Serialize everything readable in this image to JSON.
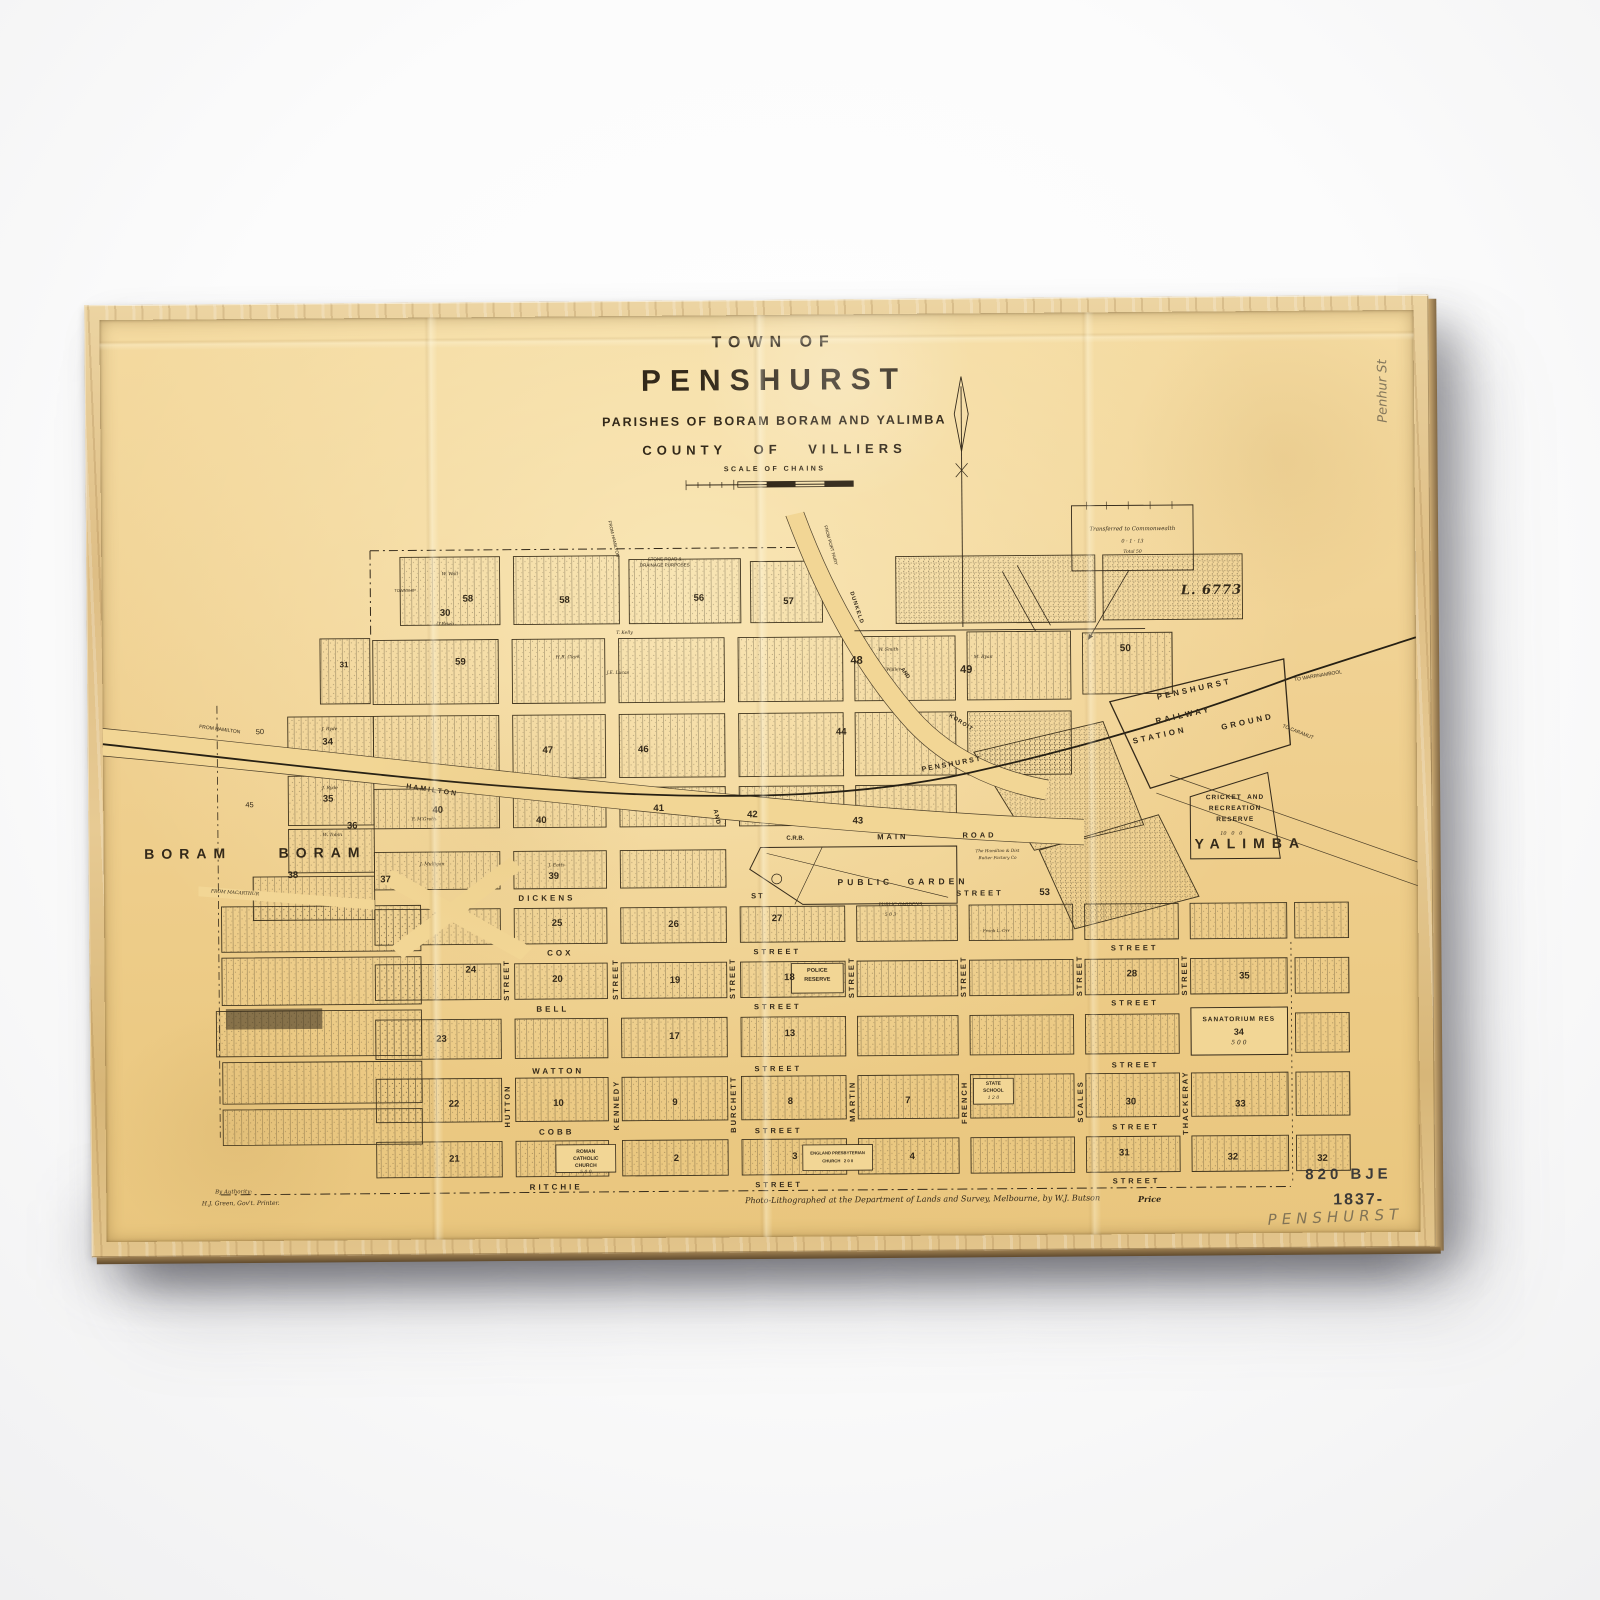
{
  "colors": {
    "paper": "#f0d192",
    "ink": "#33291a",
    "frame_wood": "#ddbd84",
    "pencil": "#645c4c",
    "wall": "#fafafa"
  },
  "map": {
    "title": {
      "line1": "TOWN OF",
      "line2": "PENSHURST",
      "line3": "PARISHES OF BORAM BORAM AND YALIMBA",
      "line4": "COUNTY OF VILLIERS",
      "scale_label": "SCALE OF CHAINS"
    },
    "labels": [
      {
        "t": "DICKENS",
        "x": 445,
        "y": 590,
        "s": 8,
        "ls": 3
      },
      {
        "t": "ST",
        "x": 657,
        "y": 589,
        "s": 7.5,
        "ls": 2
      },
      {
        "t": "STREET",
        "x": 880,
        "y": 588,
        "s": 7.5,
        "ls": 3
      },
      {
        "t": "COX",
        "x": 458,
        "y": 646,
        "s": 8,
        "ls": 3
      },
      {
        "t": "STREET",
        "x": 676,
        "y": 646,
        "s": 7.5,
        "ls": 3
      },
      {
        "t": "STREET",
        "x": 1035,
        "y": 645,
        "s": 7.5,
        "ls": 3
      },
      {
        "t": "BELL",
        "x": 450,
        "y": 703,
        "s": 8,
        "ls": 3
      },
      {
        "t": "STREET",
        "x": 676,
        "y": 702,
        "s": 7.5,
        "ls": 3
      },
      {
        "t": "STREET",
        "x": 1035,
        "y": 701,
        "s": 7.5,
        "ls": 3
      },
      {
        "t": "WATTON",
        "x": 455,
        "y": 766,
        "s": 8,
        "ls": 3
      },
      {
        "t": "STREET",
        "x": 676,
        "y": 765,
        "s": 7.5,
        "ls": 3
      },
      {
        "t": "STREET",
        "x": 1035,
        "y": 764,
        "s": 7.5,
        "ls": 3
      },
      {
        "t": "COBB",
        "x": 453,
        "y": 828,
        "s": 8,
        "ls": 3
      },
      {
        "t": "STREET",
        "x": 676,
        "y": 827,
        "s": 7.5,
        "ls": 3
      },
      {
        "t": "STREET",
        "x": 1035,
        "y": 826,
        "s": 7.5,
        "ls": 3
      },
      {
        "t": "RITCHIE",
        "x": 452,
        "y": 883,
        "s": 8,
        "ls": 3
      },
      {
        "t": "STREET",
        "x": 676,
        "y": 882,
        "s": 7.5,
        "ls": 3
      },
      {
        "t": "STREET",
        "x": 1035,
        "y": 881,
        "s": 7.5,
        "ls": 3
      },
      {
        "t": "C.R.B.",
        "x": 695,
        "y": 531,
        "s": 6
      },
      {
        "t": "MAIN",
        "x": 793,
        "y": 530,
        "s": 7.5,
        "ls": 3
      },
      {
        "t": "ROAD",
        "x": 880,
        "y": 529,
        "s": 7.5,
        "ls": 3
      },
      {
        "t": "STREET",
        "x": 404,
        "y": 672,
        "s": 7.5,
        "ls": 2,
        "r": -90
      },
      {
        "t": "HUTTON",
        "x": 404,
        "y": 800,
        "s": 7.5,
        "ls": 2,
        "r": -90
      },
      {
        "t": "STREET",
        "x": 513,
        "y": 672,
        "s": 7.5,
        "ls": 2,
        "r": -90
      },
      {
        "t": "KENNEDY",
        "x": 513,
        "y": 800,
        "s": 7.5,
        "ls": 2,
        "r": -90
      },
      {
        "t": "STREET",
        "x": 631,
        "y": 672,
        "s": 7.5,
        "ls": 2,
        "r": -90
      },
      {
        "t": "BURCHETT",
        "x": 631,
        "y": 800,
        "s": 7.5,
        "ls": 2,
        "r": -90
      },
      {
        "t": "STREET",
        "x": 750,
        "y": 672,
        "s": 7.5,
        "ls": 2,
        "r": -90
      },
      {
        "t": "MARTIN",
        "x": 750,
        "y": 798,
        "s": 7.5,
        "ls": 2,
        "r": -90
      },
      {
        "t": "STREET",
        "x": 863,
        "y": 672,
        "s": 7.5,
        "ls": 2,
        "r": -90
      },
      {
        "t": "FRENCH",
        "x": 863,
        "y": 800,
        "s": 7.5,
        "ls": 2,
        "r": -90
      },
      {
        "t": "STREET",
        "x": 979,
        "y": 672,
        "s": 7.5,
        "ls": 2,
        "r": -90
      },
      {
        "t": "SCALES",
        "x": 979,
        "y": 800,
        "s": 7.5,
        "ls": 2,
        "r": -90
      },
      {
        "t": "STREET",
        "x": 1085,
        "y": 672,
        "s": 7.5,
        "ls": 2,
        "r": -90
      },
      {
        "t": "THACKERAY",
        "x": 1085,
        "y": 802,
        "s": 7.5,
        "ls": 2,
        "r": -90
      },
      {
        "t": "FROM HAMILTON",
        "x": 118,
        "y": 417,
        "s": 5,
        "r": 8,
        "c": "n"
      },
      {
        "t": "HAMILTON",
        "x": 330,
        "y": 480,
        "s": 7,
        "r": 9,
        "ls": 2
      },
      {
        "t": "AND",
        "x": 616,
        "y": 509,
        "s": 6,
        "r": 78,
        "ls": 1
      },
      {
        "t": "PENSHURST",
        "x": 853,
        "y": 457,
        "s": 7,
        "r": -10,
        "ls": 2
      },
      {
        "t": "FROM HAMILTON",
        "x": 514,
        "y": 226,
        "s": 4.5,
        "r": 77,
        "c": "n"
      },
      {
        "t": "STONE ROAD &",
        "x": 566,
        "y": 247,
        "s": 4.5,
        "c": "n"
      },
      {
        "t": "DRAINAGE PURPOSES",
        "x": 566,
        "y": 254,
        "s": 4.5,
        "c": "n"
      },
      {
        "t": "FROM PORT FAIRY",
        "x": 732,
        "y": 234,
        "s": 4.5,
        "r": 75,
        "c": "n"
      },
      {
        "t": "DUNKELD",
        "x": 757,
        "y": 298,
        "s": 5.5,
        "r": 72,
        "ls": 1
      },
      {
        "t": "AND",
        "x": 806,
        "y": 365,
        "s": 5.5,
        "r": 55
      },
      {
        "t": "KOROIT",
        "x": 862,
        "y": 416,
        "s": 5.5,
        "r": 33,
        "ls": 1
      },
      {
        "t": "TO WARRNAMBOOL",
        "x": 1222,
        "y": 371,
        "s": 5,
        "r": -9,
        "c": "n"
      },
      {
        "t": "TO CARAMUT",
        "x": 1200,
        "y": 428,
        "s": 5,
        "r": 22,
        "c": "n"
      },
      {
        "t": "FROM MACARTHUR",
        "x": 132,
        "y": 583,
        "s": 4.5,
        "r": 4,
        "c": "i"
      },
      {
        "t": "PENSHURST",
        "x": 1097,
        "y": 383,
        "s": 8,
        "r": -12,
        "ls": 3
      },
      {
        "t": "RAILWAY",
        "x": 1086,
        "y": 410,
        "s": 8,
        "r": -12,
        "ls": 3
      },
      {
        "t": "STATION",
        "x": 1062,
        "y": 430,
        "s": 8,
        "r": -12,
        "ls": 3
      },
      {
        "t": "GROUND",
        "x": 1150,
        "y": 417,
        "s": 8,
        "r": -12,
        "ls": 3
      },
      {
        "t": "CRICKET  AND",
        "x": 1137,
        "y": 494,
        "s": 6.5,
        "ls": 1
      },
      {
        "t": "RECREATION",
        "x": 1137,
        "y": 505,
        "s": 6.5,
        "ls": 1
      },
      {
        "t": "RESERVE",
        "x": 1137,
        "y": 516,
        "s": 6.5,
        "ls": 1
      },
      {
        "t": "10   0   0",
        "x": 1133,
        "y": 530,
        "s": 5,
        "c": "i"
      },
      {
        "t": "YALIMBA",
        "x": 1152,
        "y": 540,
        "s": 14,
        "ls": 7
      },
      {
        "t": "BORAM",
        "x": 85,
        "y": 542,
        "s": 14,
        "ls": 7
      },
      {
        "t": "BORAM",
        "x": 220,
        "y": 542,
        "s": 14,
        "ls": 7
      },
      {
        "t": "PUBLIC",
        "x": 765,
        "y": 576,
        "s": 8.5,
        "ls": 4
      },
      {
        "t": "GARDEN",
        "x": 838,
        "y": 576,
        "s": 8.5,
        "ls": 4
      },
      {
        "t": "PUBLIC GARDENS",
        "x": 800,
        "y": 600,
        "s": 4.5,
        "c": "i"
      },
      {
        "t": "5 0 3",
        "x": 790,
        "y": 610,
        "s": 4.5,
        "c": "i"
      },
      {
        "t": "POLICE",
        "x": 716,
        "y": 666,
        "s": 5.5
      },
      {
        "t": "RESERVE",
        "x": 716,
        "y": 675,
        "s": 5.5
      },
      {
        "t": "STATE",
        "x": 892,
        "y": 783,
        "s": 4.8
      },
      {
        "t": "SCHOOL",
        "x": 892,
        "y": 790,
        "s": 4.8
      },
      {
        "t": "1 2 0",
        "x": 892,
        "y": 797,
        "s": 4.5,
        "c": "i"
      },
      {
        "t": "ROMAN",
        "x": 482,
        "y": 848,
        "s": 5
      },
      {
        "t": "CATHOLIC",
        "x": 482,
        "y": 855,
        "s": 5
      },
      {
        "t": "CHURCH",
        "x": 482,
        "y": 862,
        "s": 5
      },
      {
        "t": "5 0 0",
        "x": 482,
        "y": 869,
        "s": 4.5,
        "c": "i"
      },
      {
        "t": "ENGLAND PRESBYTERIAN",
        "x": 735,
        "y": 851,
        "s": 4.2
      },
      {
        "t": "CHURCH   2 0 0",
        "x": 735,
        "y": 859,
        "s": 4.2
      },
      {
        "t": "SANATORIUM RES",
        "x": 1139,
        "y": 719,
        "s": 6.5,
        "ls": 1
      },
      {
        "t": "34",
        "x": 1139,
        "y": 731,
        "s": 9
      },
      {
        "t": "5 0 0",
        "x": 1139,
        "y": 742,
        "s": 6,
        "c": "i"
      },
      {
        "t": "Transferred to Commonwealth",
        "x": 1036,
        "y": 221,
        "s": 5.5,
        "c": "i"
      },
      {
        "t": "0 · 1 · 13",
        "x": 1036,
        "y": 233,
        "s": 5,
        "c": "i"
      },
      {
        "t": "Total 50",
        "x": 1036,
        "y": 244,
        "s": 4.5,
        "c": "i"
      },
      {
        "t": "L. 6773",
        "x": 1115,
        "y": 283,
        "s": 13,
        "ls": 1,
        "c": "ib"
      },
      {
        "t": "TOWNSHIP",
        "x": 305,
        "y": 277,
        "s": 4,
        "c": "n"
      },
      {
        "t": "58",
        "x": 368,
        "y": 286,
        "s": 9.5
      },
      {
        "t": "58",
        "x": 465,
        "y": 288,
        "s": 9.5
      },
      {
        "t": "56",
        "x": 600,
        "y": 287,
        "s": 9.5
      },
      {
        "t": "57",
        "x": 690,
        "y": 291,
        "s": 9.5
      },
      {
        "t": "30",
        "x": 345,
        "y": 300,
        "s": 9.5
      },
      {
        "t": "31",
        "x": 243,
        "y": 352,
        "s": 8
      },
      {
        "t": "59",
        "x": 360,
        "y": 350,
        "s": 9.5
      },
      {
        "t": "48",
        "x": 758,
        "y": 352,
        "s": 11
      },
      {
        "t": "49",
        "x": 868,
        "y": 362,
        "s": 11
      },
      {
        "t": "50",
        "x": 1028,
        "y": 342,
        "s": 10
      },
      {
        "t": "34",
        "x": 226,
        "y": 430,
        "s": 9.5
      },
      {
        "t": "35",
        "x": 226,
        "y": 488,
        "s": 9.5
      },
      {
        "t": "36",
        "x": 250,
        "y": 515,
        "s": 9.5
      },
      {
        "t": "37",
        "x": 283,
        "y": 570,
        "s": 9.5
      },
      {
        "t": "38",
        "x": 190,
        "y": 565,
        "s": 9.5
      },
      {
        "t": "45",
        "x": 147,
        "y": 493,
        "s": 7.5,
        "c": "n"
      },
      {
        "t": "50",
        "x": 158,
        "y": 419,
        "s": 7.5,
        "c": "n"
      },
      {
        "t": "40",
        "x": 336,
        "y": 500,
        "s": 9.5
      },
      {
        "t": "47",
        "x": 447,
        "y": 440,
        "s": 9.5
      },
      {
        "t": "46",
        "x": 543,
        "y": 440,
        "s": 9.5
      },
      {
        "t": "40",
        "x": 440,
        "y": 511,
        "s": 9.5
      },
      {
        "t": "41",
        "x": 558,
        "y": 500,
        "s": 9.5
      },
      {
        "t": "42",
        "x": 652,
        "y": 507,
        "s": 9.5
      },
      {
        "t": "43",
        "x": 758,
        "y": 514,
        "s": 9.5
      },
      {
        "t": "44",
        "x": 742,
        "y": 424,
        "s": 9.5
      },
      {
        "t": "39",
        "x": 452,
        "y": 568,
        "s": 9.5
      },
      {
        "t": "53",
        "x": 945,
        "y": 588,
        "s": 9.5
      },
      {
        "t": "25",
        "x": 455,
        "y": 616,
        "s": 9.5
      },
      {
        "t": "26",
        "x": 572,
        "y": 618,
        "s": 9.5
      },
      {
        "t": "27",
        "x": 676,
        "y": 613,
        "s": 9.5
      },
      {
        "t": "24",
        "x": 368,
        "y": 662,
        "s": 9.5
      },
      {
        "t": "20",
        "x": 455,
        "y": 672,
        "s": 9.5
      },
      {
        "t": "19",
        "x": 573,
        "y": 674,
        "s": 9.5
      },
      {
        "t": "18",
        "x": 688,
        "y": 672,
        "s": 9.5
      },
      {
        "t": "23",
        "x": 338,
        "y": 732,
        "s": 9.5
      },
      {
        "t": "17",
        "x": 572,
        "y": 731,
        "s": 9.5
      },
      {
        "t": "13",
        "x": 688,
        "y": 729,
        "s": 9.5
      },
      {
        "t": "22",
        "x": 350,
        "y": 798,
        "s": 9.5
      },
      {
        "t": "10",
        "x": 455,
        "y": 798,
        "s": 9.5
      },
      {
        "t": "9",
        "x": 572,
        "y": 798,
        "s": 9.5
      },
      {
        "t": "8",
        "x": 688,
        "y": 798,
        "s": 9.5
      },
      {
        "t": "7",
        "x": 806,
        "y": 798,
        "s": 9.5
      },
      {
        "t": "21",
        "x": 350,
        "y": 854,
        "s": 9.5
      },
      {
        "t": "2",
        "x": 573,
        "y": 855,
        "s": 9.5
      },
      {
        "t": "3",
        "x": 692,
        "y": 854,
        "s": 9.5
      },
      {
        "t": "4",
        "x": 810,
        "y": 855,
        "s": 9.5
      },
      {
        "t": "28",
        "x": 1032,
        "y": 671,
        "s": 9.5
      },
      {
        "t": "35",
        "x": 1145,
        "y": 674,
        "s": 9.5
      },
      {
        "t": "30",
        "x": 1030,
        "y": 801,
        "s": 9.5
      },
      {
        "t": "33",
        "x": 1140,
        "y": 804,
        "s": 9.5
      },
      {
        "t": "31",
        "x": 1023,
        "y": 853,
        "s": 9.5
      },
      {
        "t": "32",
        "x": 1132,
        "y": 858,
        "s": 9.5
      },
      {
        "t": "32",
        "x": 1222,
        "y": 860,
        "s": 9.5
      },
      {
        "t": "W. Wall",
        "x": 350,
        "y": 262,
        "s": 4.5,
        "c": "i"
      },
      {
        "t": "O'Brien",
        "x": 345,
        "y": 312,
        "s": 4.5,
        "c": "i"
      },
      {
        "t": "T. Kelly",
        "x": 525,
        "y": 322,
        "s": 4.5,
        "c": "i"
      },
      {
        "t": "J. Ryde",
        "x": 228,
        "y": 418,
        "s": 4.5,
        "c": "i"
      },
      {
        "t": "J. Ryde",
        "x": 228,
        "y": 478,
        "s": 4.5,
        "c": "i"
      },
      {
        "t": "W. Tobin",
        "x": 230,
        "y": 525,
        "s": 4.5,
        "c": "i"
      },
      {
        "t": "W. Smith",
        "x": 790,
        "y": 342,
        "s": 4.5,
        "c": "i"
      },
      {
        "t": "Waller",
        "x": 795,
        "y": 362,
        "s": 4.5,
        "c": "i"
      },
      {
        "t": "M. Ryan",
        "x": 885,
        "y": 350,
        "s": 4.5,
        "c": "i"
      },
      {
        "t": "H.R. Clark",
        "x": 468,
        "y": 347,
        "s": 4.5,
        "c": "i"
      },
      {
        "t": "J.E. Lucas",
        "x": 518,
        "y": 363,
        "s": 4.5,
        "c": "i"
      },
      {
        "t": "F. M'Groth",
        "x": 322,
        "y": 510,
        "s": 4.5,
        "c": "i"
      },
      {
        "t": "J. Eatts",
        "x": 455,
        "y": 558,
        "s": 4.5,
        "c": "i"
      },
      {
        "t": "J. Mulligan",
        "x": 330,
        "y": 556,
        "s": 4.5,
        "c": "i"
      },
      {
        "t": "The Hamilton & Dist",
        "x": 898,
        "y": 546,
        "s": 4.2,
        "c": "i"
      },
      {
        "t": "Butter Factory Co",
        "x": 898,
        "y": 553,
        "s": 4.2,
        "c": "i"
      },
      {
        "t": "Frank L. Orr",
        "x": 896,
        "y": 627,
        "s": 4.2,
        "c": "i"
      },
      {
        "t": "By Authority:",
        "x": 128,
        "y": 886,
        "s": 5.5,
        "c": "i"
      },
      {
        "t": "H.J. Green, Gov't. Printer.",
        "x": 135,
        "y": 897,
        "s": 6,
        "c": "i"
      },
      {
        "t": "Photo-Lithographed at the Department of Lands and Survey, Melbourne, by W.J. Butson",
        "x": 820,
        "y": 898,
        "s": 8,
        "c": "i"
      },
      {
        "t": "Price",
        "x": 1048,
        "y": 899,
        "s": 8,
        "c": "ib"
      },
      {
        "t": "820 BJE",
        "x": 1248,
        "y": 876,
        "s": 15,
        "ls": 4,
        "c": "s"
      },
      {
        "t": "1837-",
        "x": 1258,
        "y": 903,
        "s": 16,
        "ls": 2,
        "c": "s"
      },
      {
        "t": "PENSHURST",
        "x": 1235,
        "y": 920,
        "s": 15,
        "ls": 5,
        "c": "p",
        "r": -2
      },
      {
        "t": "Penhur St",
        "x": 1289,
        "y": 82,
        "s": 13,
        "c": "p",
        "r": -90
      }
    ]
  }
}
